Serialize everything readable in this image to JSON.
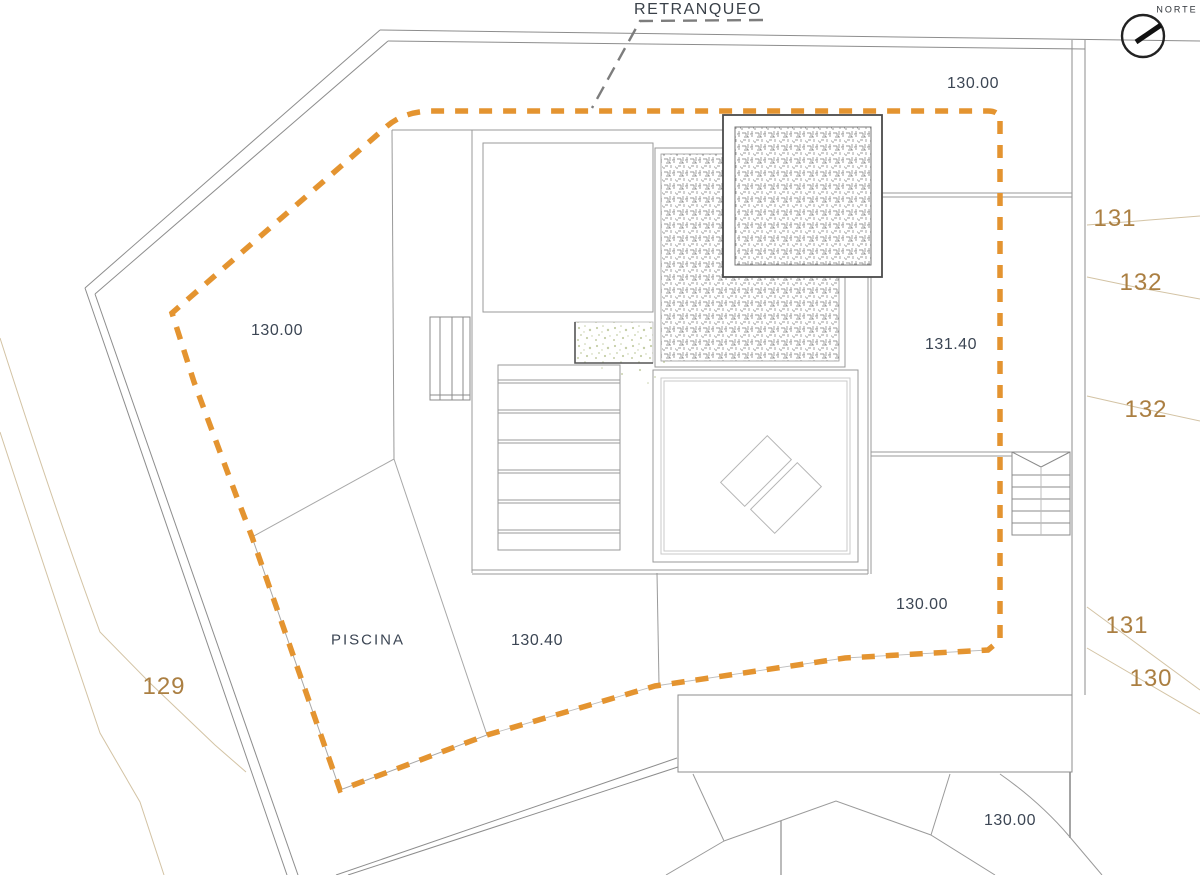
{
  "plan": {
    "labels": {
      "retranqueo": "RETRANQUEO",
      "norte": "NORTE",
      "piscina": "PISCINA"
    },
    "spot_elevations": {
      "top": "130.00",
      "west": "130.00",
      "terrace_upper": "131.40",
      "terrace_lower": "130.00",
      "pool_deck": "130.40",
      "south": "130.00"
    },
    "contours": {
      "ne_131": "131",
      "ne_132_a": "132",
      "ne_132_b": "132",
      "se_131": "131",
      "se_130": "130",
      "sw_129": "129"
    },
    "colors": {
      "setback_line": "#E49430",
      "contour_text": "#AB7F42",
      "annotation_text": "#3C4654",
      "drawing_line": "#9A9A9A"
    }
  }
}
